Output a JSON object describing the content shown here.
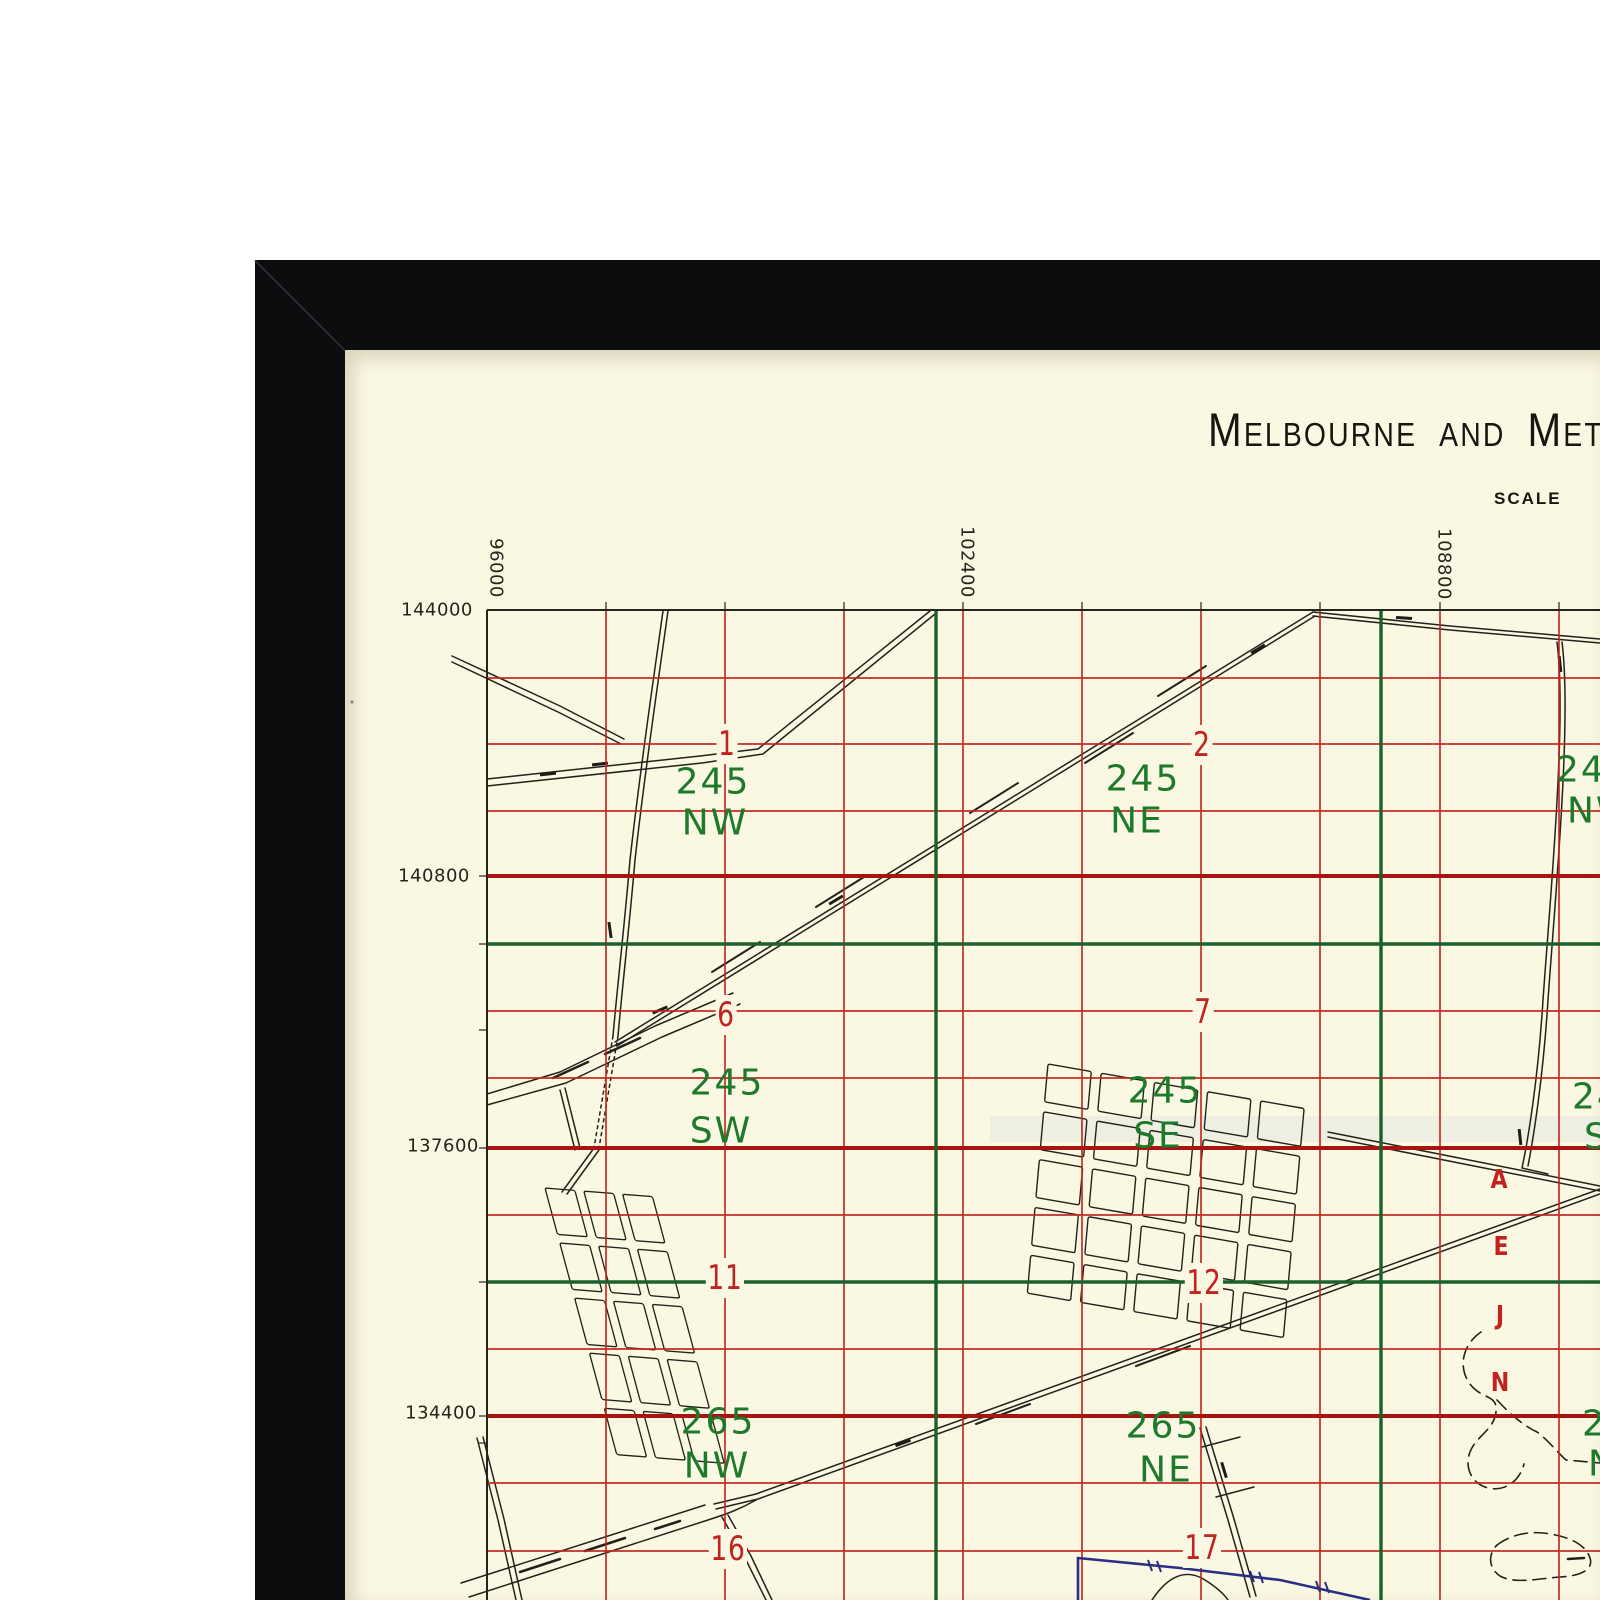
{
  "artwork": {
    "title": "Melbourne and Metrop",
    "scale_label": "SCALE",
    "frame_color": "#0d0d10",
    "paper_color": "#faf7e3"
  },
  "grid": {
    "eastings": [
      "96000",
      "102400",
      "108800"
    ],
    "northings": [
      "144000",
      "140800",
      "137600",
      "134400"
    ],
    "red_minor_color": "#c4221d",
    "red_major_color": "#a81410",
    "green_color": "#1a622c"
  },
  "sheets": {
    "nw": {
      "num": "1",
      "name": "245",
      "quad": "NW"
    },
    "ne": {
      "num": "2",
      "name": "245",
      "quad": "NE"
    },
    "enw": {
      "name": "246",
      "quad": "NW"
    },
    "sw": {
      "num": "6",
      "name": "245",
      "quad": "SW"
    },
    "se": {
      "num": "7",
      "name": "245",
      "quad": "SE"
    },
    "esw": {
      "name": "246",
      "quad": "SW"
    },
    "nw2": {
      "num": "11",
      "name": "265",
      "quad": "NW"
    },
    "ne2": {
      "num": "12",
      "name": "265",
      "quad": "NE"
    },
    "enw2": {
      "name": "266",
      "quad": "NW"
    },
    "num16": "16",
    "num17": "17"
  },
  "letters": [
    "A",
    "E",
    "J",
    "N"
  ],
  "colors": {
    "label_green": "#1d7a2b",
    "label_red": "#c22220",
    "map_black": "#23221a",
    "boundary_navy": "#2a2f86"
  }
}
